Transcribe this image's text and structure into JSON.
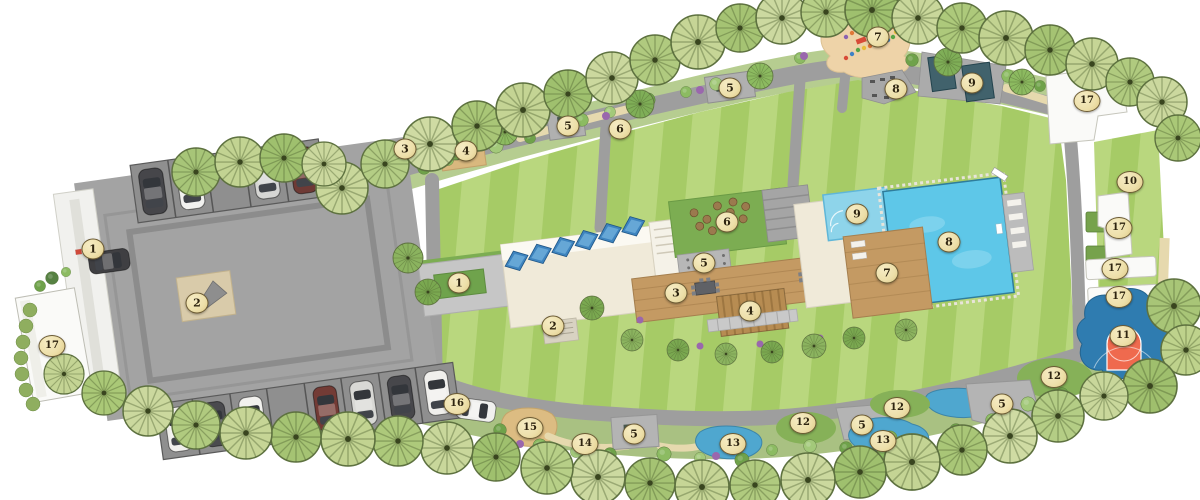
{
  "map": {
    "description": "Residential development master plan site map (top view) with numbered amenity markers",
    "marker_style": {
      "fill": "#eddfa9",
      "border": "#6b5a33",
      "text": "#2e2410"
    },
    "colors": {
      "background": "#ffffff",
      "lawn_light": "#b9d77e",
      "lawn_dark": "#a6cb66",
      "road": "#9e9e9e",
      "plaza": "#a3a3a3",
      "pool": "#5ec7e8",
      "kids_pool": "#8ed4ea",
      "wood_deck": "#c49a63",
      "sand": "#eed3a8",
      "court_blue": "#2f7cb0",
      "court_key": "#ef6a4e",
      "water_feature": "#41626c",
      "stream": "#4fa7cf",
      "building_cream": "#f0ead9",
      "building_white": "#fafaf8",
      "garden_green": "#7cad52"
    },
    "markers": [
      {
        "label": "1",
        "x": 93,
        "y": 249
      },
      {
        "label": "2",
        "x": 197,
        "y": 303
      },
      {
        "label": "17",
        "x": 52,
        "y": 346
      },
      {
        "label": "3",
        "x": 405,
        "y": 149
      },
      {
        "label": "4",
        "x": 466,
        "y": 151
      },
      {
        "label": "5",
        "x": 568,
        "y": 126
      },
      {
        "label": "6",
        "x": 620,
        "y": 129
      },
      {
        "label": "5",
        "x": 730,
        "y": 88
      },
      {
        "label": "7",
        "x": 878,
        "y": 37
      },
      {
        "label": "8",
        "x": 896,
        "y": 89
      },
      {
        "label": "9",
        "x": 972,
        "y": 83
      },
      {
        "label": "17",
        "x": 1087,
        "y": 101
      },
      {
        "label": "10",
        "x": 1130,
        "y": 182
      },
      {
        "label": "17",
        "x": 1119,
        "y": 228
      },
      {
        "label": "17",
        "x": 1115,
        "y": 269
      },
      {
        "label": "17",
        "x": 1119,
        "y": 297
      },
      {
        "label": "11",
        "x": 1123,
        "y": 336
      },
      {
        "label": "12",
        "x": 1054,
        "y": 377
      },
      {
        "label": "5",
        "x": 1002,
        "y": 404
      },
      {
        "label": "12",
        "x": 897,
        "y": 408
      },
      {
        "label": "5",
        "x": 862,
        "y": 425
      },
      {
        "label": "13",
        "x": 883,
        "y": 441
      },
      {
        "label": "12",
        "x": 803,
        "y": 423
      },
      {
        "label": "13",
        "x": 733,
        "y": 444
      },
      {
        "label": "5",
        "x": 634,
        "y": 434
      },
      {
        "label": "14",
        "x": 585,
        "y": 444
      },
      {
        "label": "15",
        "x": 530,
        "y": 428
      },
      {
        "label": "16",
        "x": 457,
        "y": 404
      },
      {
        "label": "1",
        "x": 459,
        "y": 283
      },
      {
        "label": "2",
        "x": 553,
        "y": 326
      },
      {
        "label": "3",
        "x": 676,
        "y": 293
      },
      {
        "label": "4",
        "x": 750,
        "y": 311
      },
      {
        "label": "5",
        "x": 704,
        "y": 263
      },
      {
        "label": "6",
        "x": 727,
        "y": 222
      },
      {
        "label": "7",
        "x": 887,
        "y": 273
      },
      {
        "label": "8",
        "x": 949,
        "y": 242
      },
      {
        "label": "9",
        "x": 857,
        "y": 214
      }
    ]
  }
}
